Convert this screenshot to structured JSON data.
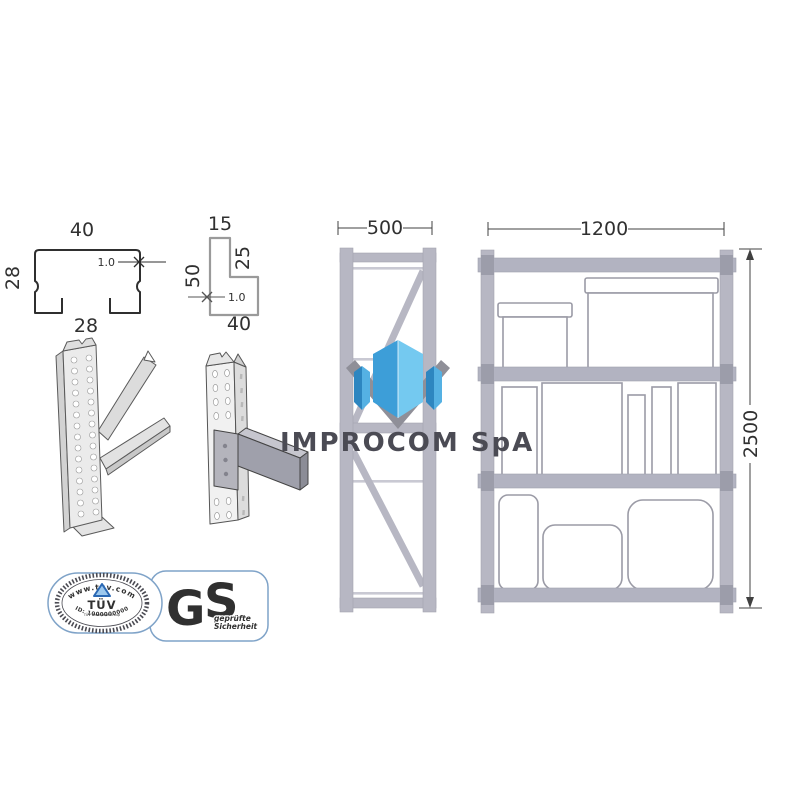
{
  "profiles": {
    "c_channel": {
      "top": "40",
      "side": "28",
      "bottom": "28",
      "thickness": "1.0"
    },
    "l_angle": {
      "top": "15",
      "right": "25",
      "left": "50",
      "bottom": "40",
      "thickness": "1.0"
    }
  },
  "frame_side": {
    "depth": "500"
  },
  "rack_front": {
    "width": "1200",
    "height": "2500"
  },
  "watermark": {
    "company": "IMPROCOM SpA"
  },
  "certifications": {
    "tuv": {
      "url": "www.tuv.com",
      "name": "TÜV",
      "group": "TÜV Rheinland Group",
      "id": "ID: 1000000000"
    },
    "gs": {
      "g": "G",
      "s": "S",
      "line1": "geprüfte",
      "line2": "Sicherheit"
    }
  },
  "colors": {
    "rack_gray": "#b6b7c3",
    "end_plate": "#9c9daa",
    "outline_dark": "#2f2f2f",
    "outline_light": "#9a9a9a",
    "crystal_light": "#74c9f0",
    "crystal_mid": "#3d9ed8",
    "crystal_dark": "#2d86c0",
    "chevron_gray": "#8f8f98",
    "gs_blue": "#1f9cd8",
    "tuv_navy": "#1c2b55",
    "badge_border": "#7fa3c8"
  }
}
